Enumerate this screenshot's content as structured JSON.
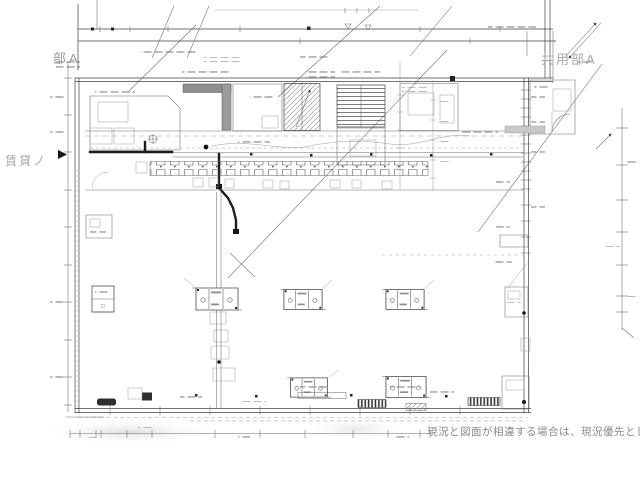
{
  "labels": {
    "top_left_area": "部A",
    "left_area": "賃貸ノ",
    "top_right_area": "共用部A",
    "bottom_note": "現況と図面が相違する場合は、現況優先とし"
  },
  "colors": {
    "paper": "#ffffff",
    "ink": "#3f3f3f",
    "label_gray": "#9e9e9e",
    "note_gray": "#8a8a8a",
    "core_shade": "#8f8f8f"
  },
  "drawing": {
    "kind": "architectural floor plan",
    "features": [
      "dimension lines",
      "break lines",
      "stair with treads",
      "hatched stair",
      "shaded shaft",
      "corridor fixture row",
      "equipment blocks",
      "section-cut arrows",
      "door swing arc"
    ]
  }
}
